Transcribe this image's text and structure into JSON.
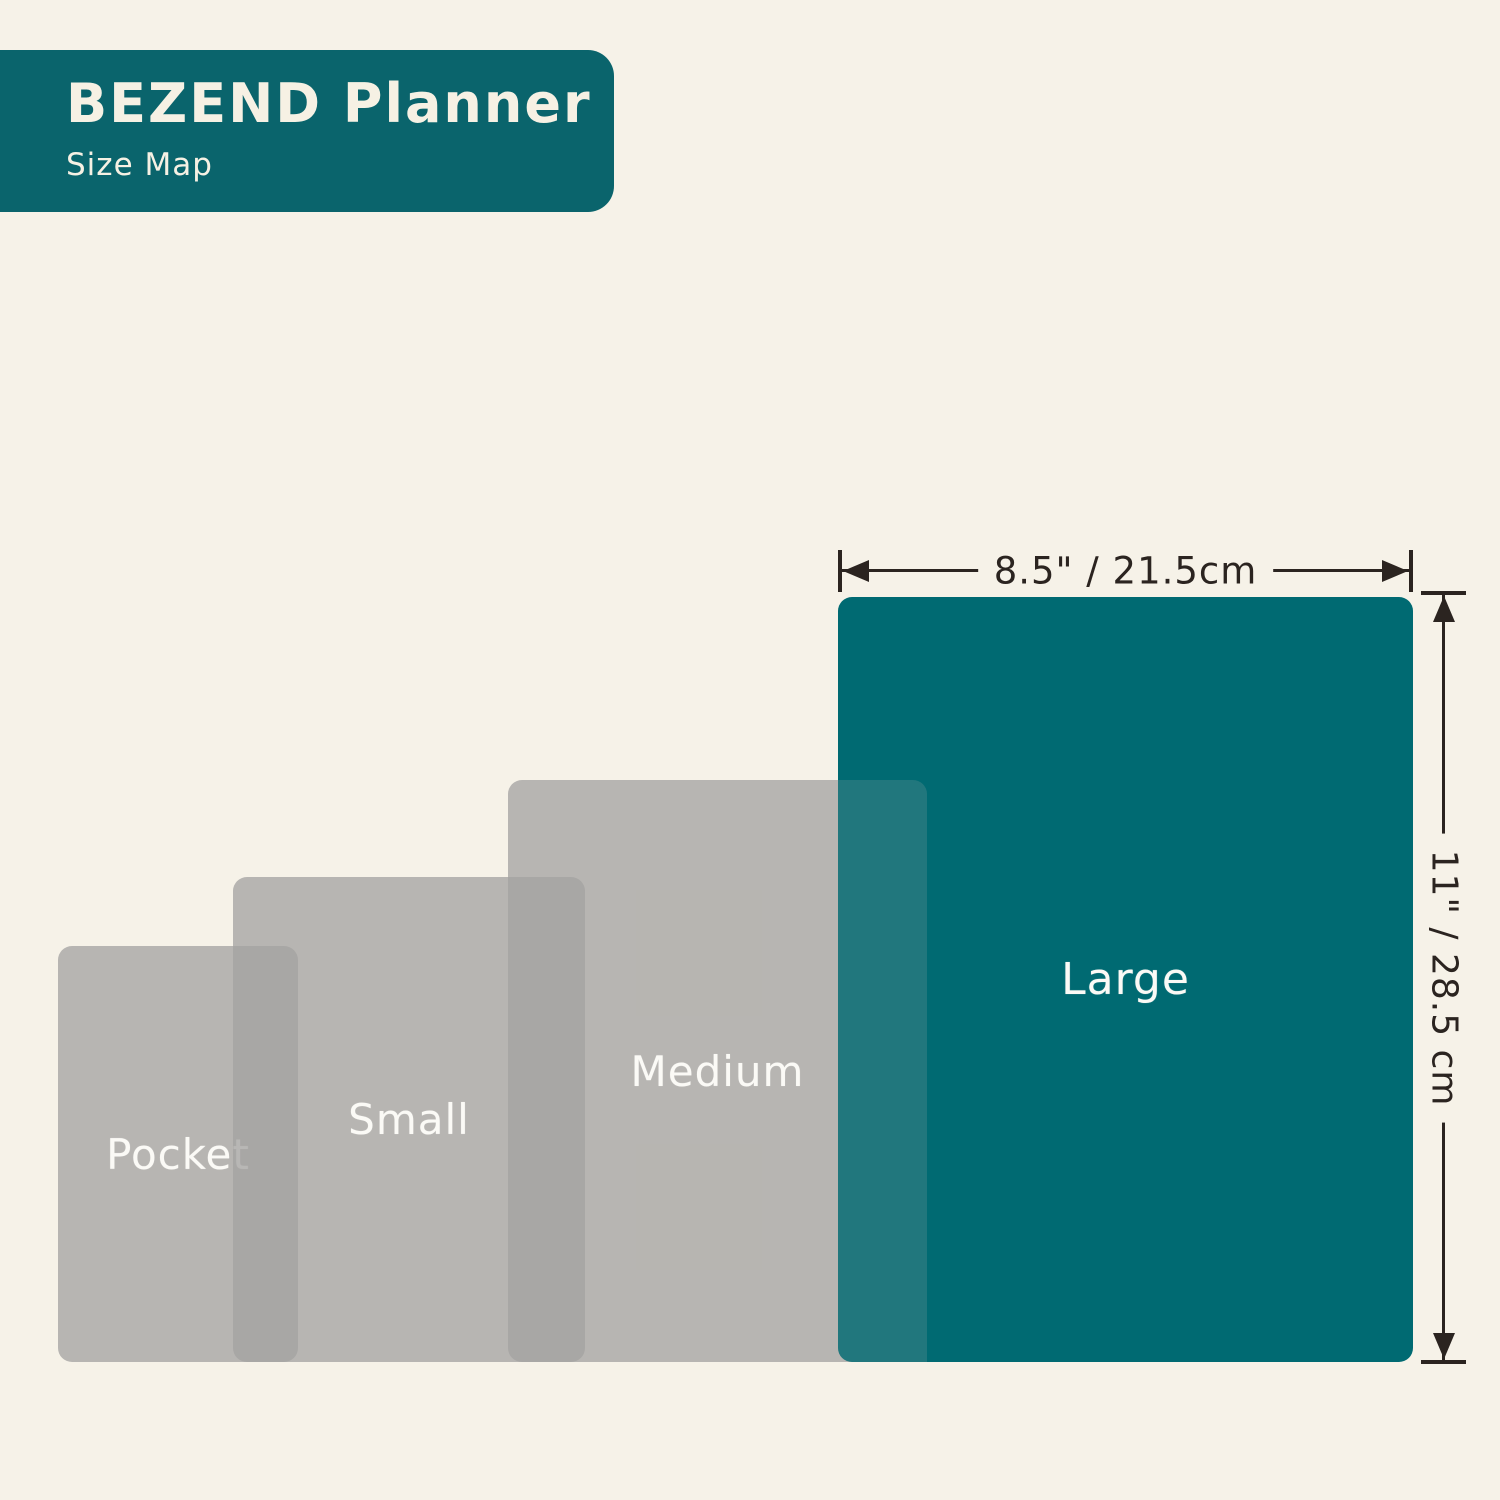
{
  "header": {
    "title": "BEZEND Planner",
    "subtitle": "Size Map"
  },
  "sizes": [
    {
      "label": "Pocket"
    },
    {
      "label": "Small"
    },
    {
      "label": "Medium"
    },
    {
      "label": "Large"
    }
  ],
  "dimensions": {
    "width_label": "8.5\" / 21.5cm",
    "height_label": "11\" / 28.5 cm"
  },
  "colors": {
    "background": "#F6F2E8",
    "header_teal": "#0A646C",
    "large_teal": "#006A72",
    "gray_planner": "#B7B6B4",
    "gray_overlap": "#A9A8A8",
    "label_text": "#FBFAF6",
    "dimension_ink": "#2B2420"
  }
}
